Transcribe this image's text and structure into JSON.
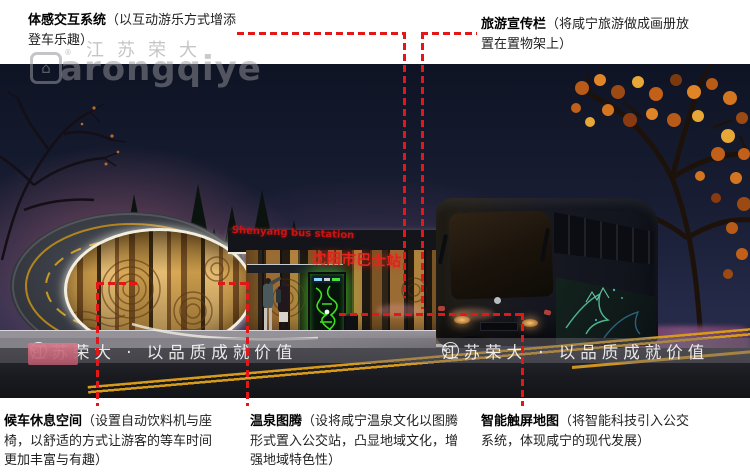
{
  "annotations": {
    "line_color": "#e31717",
    "top_left": {
      "title": "体感交互系统",
      "desc": "（以互动游乐方式增添登车乐趣）"
    },
    "top_right": {
      "title": "旅游宣传栏",
      "desc": "（将咸宁旅游做成画册放置在置物架上）"
    },
    "bottom_left": {
      "title": "候车休息空间",
      "desc": "（设置自动饮料机与座椅，以舒适的方式让游客的等车时间更加丰富与有趣）"
    },
    "bottom_middle": {
      "title": "温泉图腾",
      "desc": "（设将咸宁温泉文化以图腾形式置入公交站，凸显地域文化，增强地域特色性）"
    },
    "bottom_right": {
      "title": "智能触屏地图",
      "desc": "（将智能科技引入公交系统，体现咸宁的现代发展）"
    }
  },
  "scene": {
    "sign_en": "Shenyang bus station",
    "sign_cn": "沈阳市巴士站",
    "sign_color": "#d31414"
  },
  "watermark": {
    "brand_cn": "江苏荣大",
    "brand_latin": "arongqiye",
    "banner_text": "江苏荣大 · 以品质成就价值",
    "reg_mark": "®",
    "logo_glyph": "⌂"
  }
}
